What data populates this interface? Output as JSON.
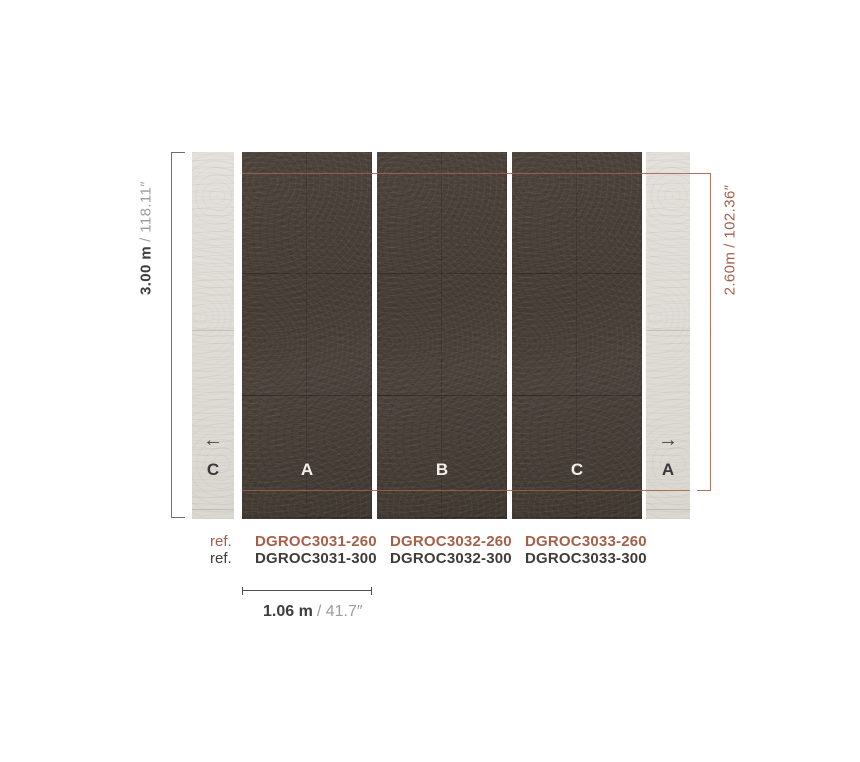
{
  "canvas": {
    "width": 860,
    "height": 762,
    "background": "#ffffff"
  },
  "colors": {
    "accent_red": "#a5604a",
    "dark_panel": "#48403a",
    "light_panel": "#e1ded9",
    "text_dark": "#3d3d3d",
    "text_gray": "#9c9c9c",
    "bracket_gray": "#6f6f6f"
  },
  "dimensions": {
    "left_height": {
      "metric": "3.00 m",
      "imperial": "/ 118.11″"
    },
    "right_height": {
      "metric": "2.60m",
      "imperial": "/ 102.36″"
    },
    "panel_width": {
      "metric": "1.06 m",
      "imperial": "/ 41.7″"
    }
  },
  "panels": [
    {
      "type": "light",
      "label": "C",
      "arrow": "←"
    },
    {
      "type": "dark",
      "label": "A"
    },
    {
      "type": "dark",
      "label": "B"
    },
    {
      "type": "dark",
      "label": "C"
    },
    {
      "type": "light",
      "label": "A",
      "arrow": "→"
    }
  ],
  "references": {
    "row_260_label": "ref.",
    "row_300_label": "ref.",
    "columns": [
      {
        "code_260": "DGROC3031-260",
        "code_300": "DGROC3031-300"
      },
      {
        "code_260": "DGROC3032-260",
        "code_300": "DGROC3032-300"
      },
      {
        "code_260": "DGROC3033-260",
        "code_300": "DGROC3033-300"
      }
    ]
  }
}
